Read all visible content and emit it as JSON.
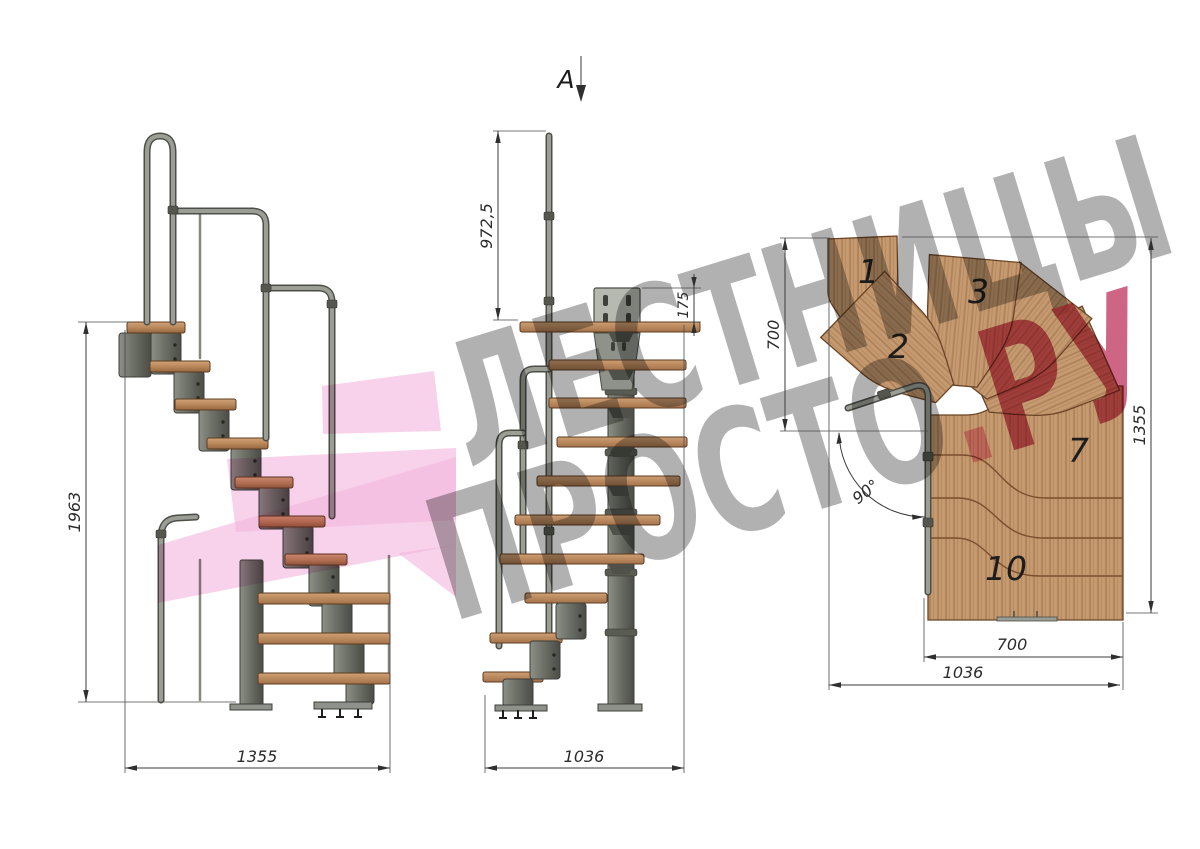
{
  "drawing": {
    "section_marker": "A",
    "side_view": {
      "height_label": "1963",
      "width_label": "1355"
    },
    "front_view": {
      "rail_height_label": "972,5",
      "plate_offset_label": "175",
      "width_label": "1036"
    },
    "plan_view": {
      "left_height_label": "700",
      "right_height_label": "1355",
      "inner_width_label": "700",
      "outer_width_label": "1036",
      "angle_label": "90°",
      "treads": {
        "t1": "1",
        "t2": "2",
        "t3": "3",
        "t7": "7",
        "t10": "10"
      }
    },
    "watermark": {
      "line1": "ЛЕСТНИЦЫ",
      "brand_gray": "ПРОСТО",
      "brand_dot": ".",
      "brand_accent": "РУ"
    },
    "colors": {
      "wood": "#c59a70",
      "metal": "#74776e",
      "arrow_pink": "#f3b7de",
      "brand_crimson": "#c64a6e",
      "watermark_gray": "#a6a6a6"
    }
  }
}
